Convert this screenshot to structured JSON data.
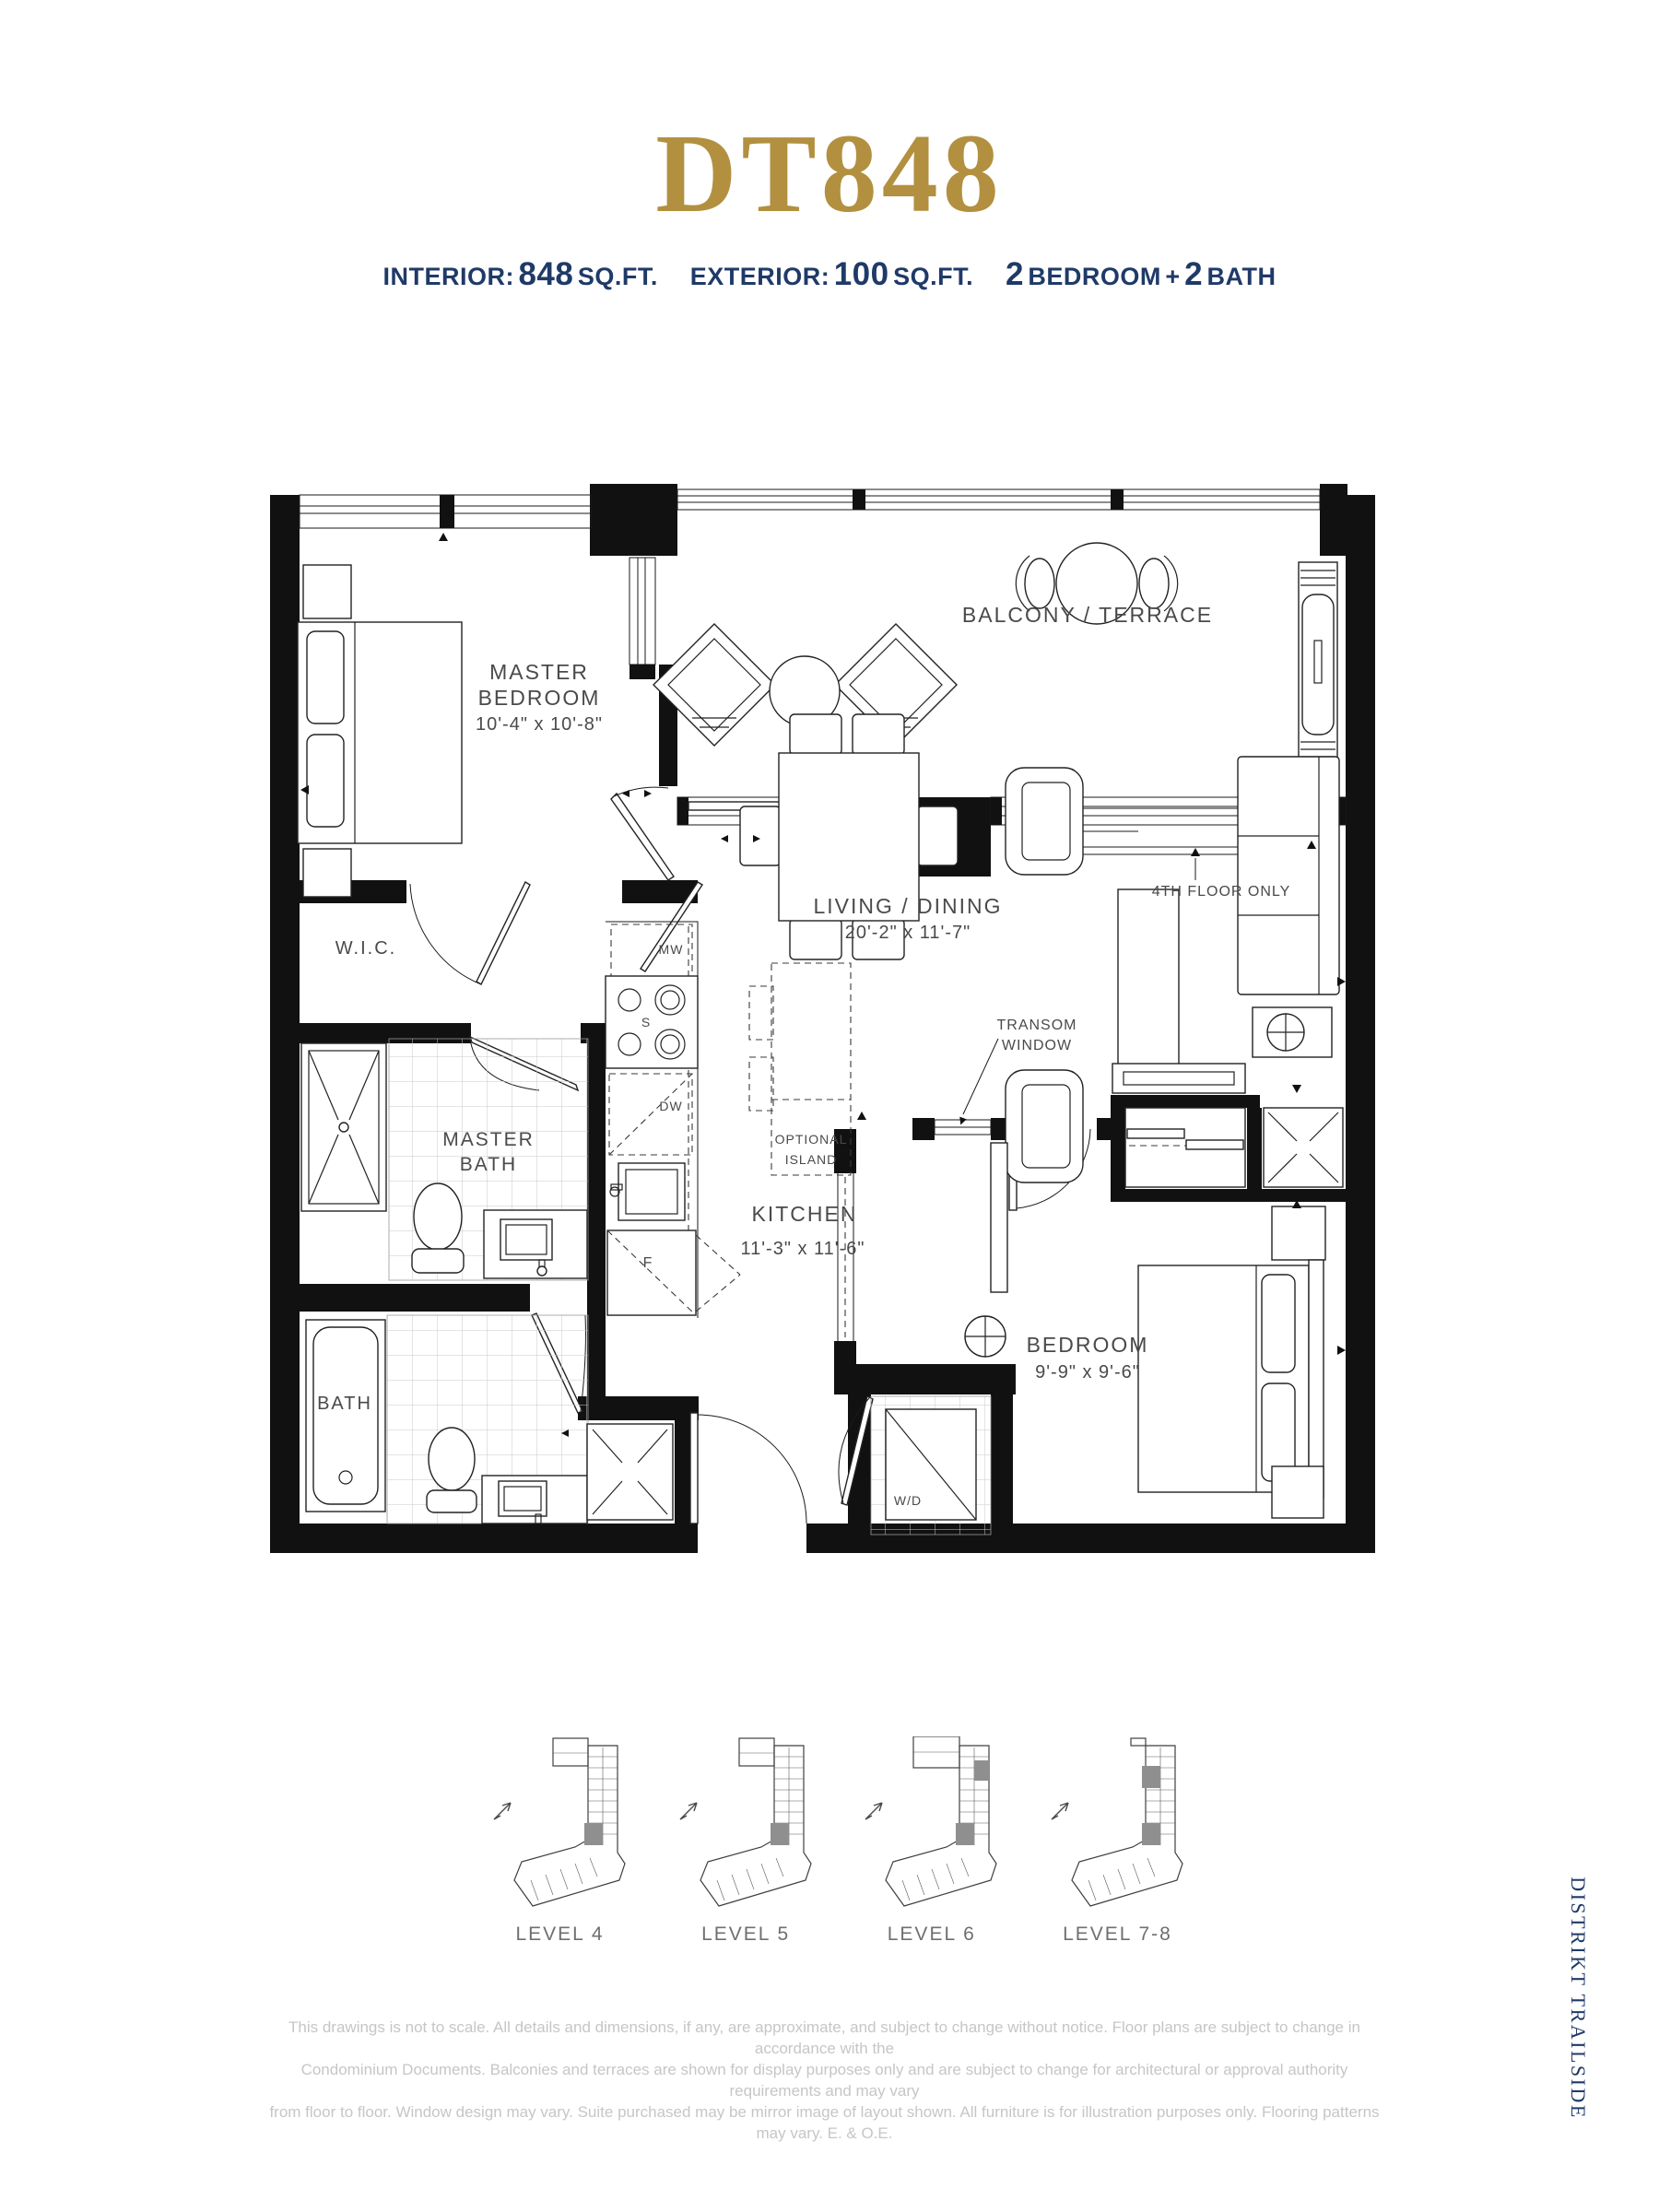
{
  "header": {
    "title": "DT848",
    "specs": {
      "interior_label": "INTERIOR:",
      "interior_value": "848",
      "interior_unit": "SQ.FT.",
      "exterior_label": "EXTERIOR:",
      "exterior_value": "100",
      "exterior_unit": "SQ.FT.",
      "bedroom_count": "2",
      "bedroom_label": "BEDROOM",
      "plus_sign": "+",
      "bath_count": "2",
      "bath_label": "BATH"
    }
  },
  "plan": {
    "labels": {
      "master_bedroom_1": "MASTER",
      "master_bedroom_2": "BEDROOM",
      "master_bedroom_dims": "10'-4\" x 10'-8\"",
      "balcony": "BALCONY / TERRACE",
      "fourth_floor_note": "4TH FLOOR ONLY",
      "living_dining": "LIVING / DINING",
      "living_dining_dims": "20'-2\" x 11'-7\"",
      "kitchen": "KITCHEN",
      "kitchen_dims": "11'-3\" x 11'-6\"",
      "optional_island_1": "OPTIONAL",
      "optional_island_2": "ISLAND",
      "wic": "W.I.C.",
      "master_bath_1": "MASTER",
      "master_bath_2": "BATH",
      "bath": "BATH",
      "bedroom": "BEDROOM",
      "bedroom_dims": "9'-9\" x 9'-6\"",
      "transom_1": "TRANSOM",
      "transom_2": "WINDOW",
      "wd": "W/D",
      "mw": "MW",
      "stove": "S",
      "dw": "DW",
      "fridge": "F"
    }
  },
  "keyplans": {
    "levels": [
      {
        "label": "LEVEL 4"
      },
      {
        "label": "LEVEL 5"
      },
      {
        "label": "LEVEL 6"
      },
      {
        "label": "LEVEL 7-8"
      }
    ]
  },
  "footer": {
    "disclaimer_line1": "This drawings is not to scale. All details and dimensions, if any, are approximate, and subject to change without notice. Floor plans are subject to change in accordance with the",
    "disclaimer_line2": "Condominium Documents. Balconies and terraces are shown for display purposes only and are subject to change for architectural or approval authority requirements and may vary",
    "disclaimer_line3": "from floor to floor. Window design may vary. Suite purchased may be mirror image of layout shown. All furniture is for illustration purposes only. Flooring patterns may vary. E. & O.E."
  },
  "brand": {
    "vertical_text": "DISTRIKT TRAILSIDE"
  },
  "colors": {
    "gold": "#B2903F",
    "navy": "#1F3A68",
    "plan_ink": "#1A1A1A",
    "label_gray": "#4A4A4A",
    "keyplan_unit_gray": "#8F8F8F",
    "keyplan_label_gray": "#6F6F6F",
    "disclaimer_gray": "#C6C6C6"
  }
}
